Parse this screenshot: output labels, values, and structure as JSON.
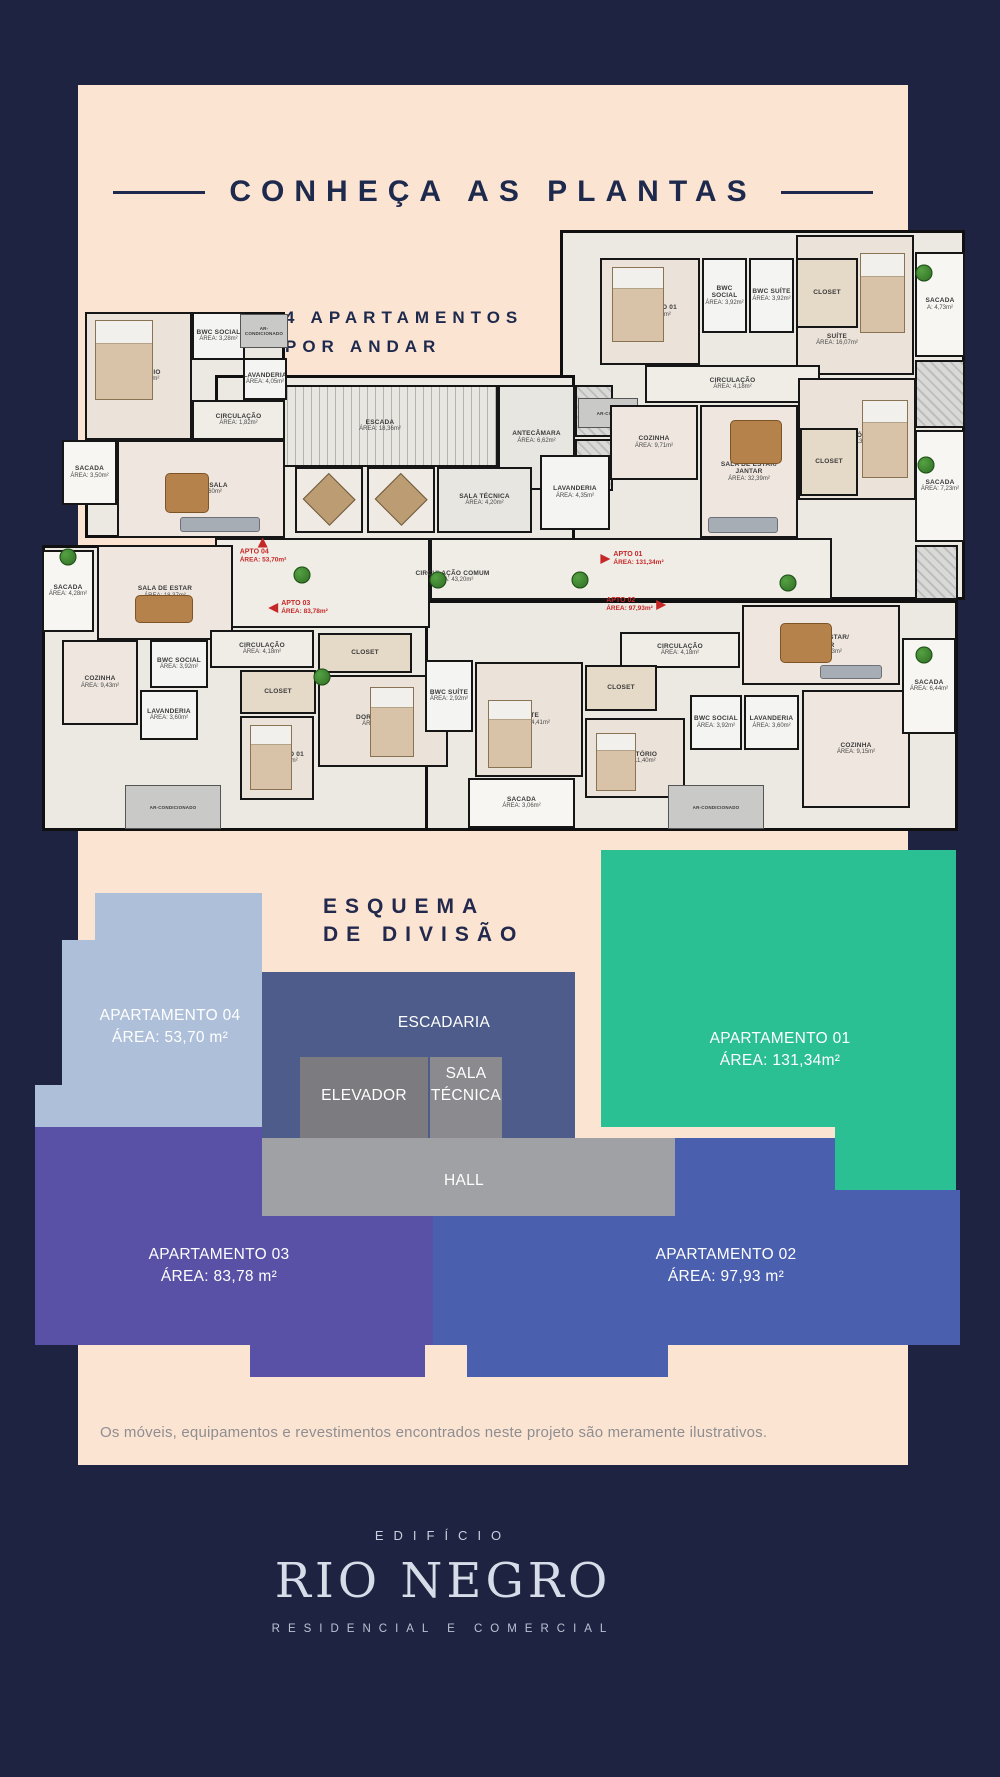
{
  "page": {
    "bg": "#1e2342",
    "card_bg": "#fce4d3",
    "accent_red": "#c62828",
    "navy": "#1e2a4d"
  },
  "header": {
    "title": "CONHEÇA AS PLANTAS",
    "subtitle_line1": "4 APARTAMENTOS",
    "subtitle_line2": "POR ANDAR"
  },
  "floor_plan": {
    "slabs": [
      [
        45,
        87,
        200,
        226
      ],
      [
        520,
        5,
        405,
        370
      ],
      [
        2,
        320,
        445,
        286
      ],
      [
        385,
        375,
        533,
        231
      ],
      [
        175,
        150,
        360,
        225
      ]
    ],
    "rooms": [
      {
        "n": "",
        "x": 175,
        "y": 313,
        "w": 215,
        "h": 90,
        "t": "corridor"
      },
      {
        "n": "",
        "x": 390,
        "y": 313,
        "w": 402,
        "h": 62,
        "t": "corridor"
      },
      {
        "n": "CIRCULAÇÃO COMUM",
        "a": "ÁREA: 43,20m²",
        "x": 330,
        "y": 332,
        "w": 165,
        "h": 40,
        "t": "labelonly"
      },
      {
        "n": "ESCADA",
        "a": "ÁREA: 18,36m²",
        "x": 222,
        "y": 160,
        "w": 236,
        "h": 82,
        "t": "stairs"
      },
      {
        "n": "ANTECÂMARA",
        "a": "ÁREA: 6,62m²",
        "x": 458,
        "y": 160,
        "w": 77,
        "h": 105,
        "t": "core"
      },
      {
        "n": "",
        "x": 535,
        "y": 160,
        "w": 38,
        "h": 52,
        "t": "hatch"
      },
      {
        "n": "",
        "x": 535,
        "y": 214,
        "w": 38,
        "h": 52,
        "t": "hatch"
      },
      {
        "n": "ELEVADOR",
        "x": 255,
        "y": 242,
        "w": 68,
        "h": 66,
        "t": "diamond"
      },
      {
        "n": "ELEVADOR",
        "x": 327,
        "y": 242,
        "w": 68,
        "h": 66,
        "t": "diamond"
      },
      {
        "n": "SALA TÉCNICA",
        "a": "ÁREA: 4,20m²",
        "x": 397,
        "y": 242,
        "w": 95,
        "h": 66,
        "t": "core"
      },
      {
        "n": "AR-COND",
        "x": 538,
        "y": 173,
        "w": 60,
        "h": 30,
        "t": "gray"
      },
      {
        "n": "DORMITÓRIO",
        "a": "ÁREA: 13,60m²",
        "x": 45,
        "y": 87,
        "w": 107,
        "h": 128,
        "t": "bed"
      },
      {
        "n": "BWC SOCIAL",
        "a": "ÁREA: 3,28m²",
        "x": 152,
        "y": 87,
        "w": 53,
        "h": 48,
        "t": "bath"
      },
      {
        "n": "AR-CONDICIONADO",
        "x": 200,
        "y": 89,
        "w": 48,
        "h": 34,
        "t": "gray"
      },
      {
        "n": "LAVANDERIA",
        "a": "ÁREA: 4,05m²",
        "x": 203,
        "y": 133,
        "w": 44,
        "h": 42,
        "t": "bath"
      },
      {
        "n": "CIRCULAÇÃO",
        "a": "ÁREA: 1,82m²",
        "x": 152,
        "y": 175,
        "w": 93,
        "h": 40,
        "t": "corridor"
      },
      {
        "n": "SACADA",
        "a": "ÁREA: 3,50m²",
        "x": 22,
        "y": 215,
        "w": 55,
        "h": 65,
        "t": "balcony"
      },
      {
        "n": "COZINHA/ SALA",
        "a": "ÁREA: 17,60m²",
        "x": 77,
        "y": 215,
        "w": 168,
        "h": 98,
        "t": "living"
      },
      {
        "n": "",
        "x": 756,
        "y": 10,
        "w": 118,
        "h": 140,
        "t": "bed"
      },
      {
        "n": "CLOSET",
        "x": 756,
        "y": 33,
        "w": 62,
        "h": 70,
        "t": "closet"
      },
      {
        "n": "SUÍTE",
        "a": "ÁREA: 16,07m²",
        "x": 752,
        "y": 100,
        "w": 90,
        "h": 30,
        "t": "labelonly"
      },
      {
        "n": "DORMITÓRIO 01",
        "a": "ÁREA: 12,74m²",
        "x": 560,
        "y": 33,
        "w": 100,
        "h": 107,
        "t": "bed"
      },
      {
        "n": "BWC SOCIAL",
        "a": "ÁREA: 3,92m²",
        "x": 662,
        "y": 33,
        "w": 45,
        "h": 75,
        "t": "bath"
      },
      {
        "n": "BWC SUÍTE",
        "a": "ÁREA: 3,92m²",
        "x": 709,
        "y": 33,
        "w": 45,
        "h": 75,
        "t": "bath"
      },
      {
        "n": "SACADA",
        "a": "A: 4,73m²",
        "x": 875,
        "y": 27,
        "w": 50,
        "h": 105,
        "t": "balcony"
      },
      {
        "n": "CIRCULAÇÃO",
        "a": "ÁREA: 4,18m²",
        "x": 605,
        "y": 140,
        "w": 175,
        "h": 38,
        "t": "corridor"
      },
      {
        "n": "COZINHA",
        "a": "ÁREA: 9,71m²",
        "x": 570,
        "y": 180,
        "w": 88,
        "h": 75,
        "t": "living"
      },
      {
        "n": "LAVANDERIA",
        "a": "ÁREA: 4,35m²",
        "x": 500,
        "y": 230,
        "w": 70,
        "h": 75,
        "t": "bath"
      },
      {
        "n": "DORMITÓRIO 02",
        "a": "ÁREA: 13,76m²",
        "x": 758,
        "y": 153,
        "w": 118,
        "h": 122,
        "t": "bed"
      },
      {
        "n": "CLOSET",
        "x": 760,
        "y": 203,
        "w": 58,
        "h": 68,
        "t": "closet"
      },
      {
        "n": [
          "SALA DE ESTAR/",
          "JANTAR"
        ],
        "a": "ÁREA: 32,39m²",
        "x": 660,
        "y": 180,
        "w": 98,
        "h": 133,
        "t": "living"
      },
      {
        "n": "SACADA",
        "a": "ÁREA: 7,23m²",
        "x": 875,
        "y": 205,
        "w": 50,
        "h": 112,
        "t": "balcony"
      },
      {
        "n": "",
        "x": 875,
        "y": 135,
        "w": 50,
        "h": 68,
        "t": "hatch"
      },
      {
        "n": "SACADA",
        "a": "ÁREA: 4,28m²",
        "x": 2,
        "y": 325,
        "w": 52,
        "h": 82,
        "t": "balcony"
      },
      {
        "n": "SALA DE ESTAR",
        "a": "ÁREA: 18,37m²",
        "x": 57,
        "y": 320,
        "w": 136,
        "h": 95,
        "t": "living"
      },
      {
        "n": "COZINHA",
        "a": "ÁREA: 9,43m²",
        "x": 22,
        "y": 415,
        "w": 76,
        "h": 85,
        "t": "living"
      },
      {
        "n": "BWC SOCIAL",
        "a": "ÁREA: 3,92m²",
        "x": 110,
        "y": 415,
        "w": 58,
        "h": 48,
        "t": "bath"
      },
      {
        "n": "LAVANDERIA",
        "a": "ÁREA: 3,60m²",
        "x": 100,
        "y": 465,
        "w": 58,
        "h": 50,
        "t": "bath"
      },
      {
        "n": "CIRCULAÇÃO",
        "a": "ÁREA: 4,18m²",
        "x": 170,
        "y": 405,
        "w": 104,
        "h": 38,
        "t": "corridor"
      },
      {
        "n": "CLOSET",
        "x": 200,
        "y": 445,
        "w": 76,
        "h": 44,
        "t": "closet"
      },
      {
        "n": "DORMITÓRIO 01",
        "a": "ÁREA: 11,40m²",
        "x": 200,
        "y": 491,
        "w": 74,
        "h": 84,
        "t": "bed"
      },
      {
        "n": "CLOSET",
        "x": 278,
        "y": 408,
        "w": 94,
        "h": 40,
        "t": "closet"
      },
      {
        "n": "DORMITÓRIO 02",
        "a": "ÁREA: 14,41m²",
        "x": 278,
        "y": 450,
        "w": 130,
        "h": 92,
        "t": "bed"
      },
      {
        "n": "AR-CONDICIONADO",
        "x": 85,
        "y": 560,
        "w": 96,
        "h": 44,
        "t": "gray"
      },
      {
        "n": "BWC SUÍTE",
        "a": "ÁREA: 2,92m²",
        "x": 385,
        "y": 435,
        "w": 48,
        "h": 72,
        "t": "bath"
      },
      {
        "n": "SUÍTE",
        "a": "ÁREA: 14,41m²",
        "x": 435,
        "y": 437,
        "w": 108,
        "h": 115,
        "t": "bed"
      },
      {
        "n": "SACADA",
        "a": "ÁREA: 3,06m²",
        "x": 428,
        "y": 553,
        "w": 107,
        "h": 50,
        "t": "balcony"
      },
      {
        "n": "CIRCULAÇÃO",
        "a": "ÁREA: 4,18m²",
        "x": 580,
        "y": 407,
        "w": 120,
        "h": 36,
        "t": "corridor"
      },
      {
        "n": "CLOSET",
        "x": 545,
        "y": 440,
        "w": 72,
        "h": 46,
        "t": "closet"
      },
      {
        "n": "DORMITÓRIO",
        "a": "ÁREA: 11,40m²",
        "x": 545,
        "y": 493,
        "w": 100,
        "h": 80,
        "t": "bed"
      },
      {
        "n": "BWC SOCIAL",
        "a": "ÁREA: 3,92m²",
        "x": 650,
        "y": 470,
        "w": 52,
        "h": 55,
        "t": "bath"
      },
      {
        "n": "LAVANDERIA",
        "a": "ÁREA: 3,60m²",
        "x": 704,
        "y": 470,
        "w": 55,
        "h": 55,
        "t": "bath"
      },
      {
        "n": "COZINHA",
        "a": "ÁREA: 9,15m²",
        "x": 762,
        "y": 465,
        "w": 108,
        "h": 118,
        "t": "living"
      },
      {
        "n": [
          "SALA DE ESTAR/",
          "JANTAR"
        ],
        "a": "ÁREA: 22,23m²",
        "x": 702,
        "y": 380,
        "w": 158,
        "h": 80,
        "t": "living"
      },
      {
        "n": "SACADA",
        "a": "ÁREA: 6,44m²",
        "x": 862,
        "y": 413,
        "w": 54,
        "h": 96,
        "t": "balcony"
      },
      {
        "n": "AR-CONDICIONADO",
        "x": 628,
        "y": 560,
        "w": 96,
        "h": 44,
        "t": "gray"
      },
      {
        "n": "",
        "x": 875,
        "y": 320,
        "w": 43,
        "h": 55,
        "t": "hatch"
      }
    ],
    "markers": [
      {
        "name": "APTO 04",
        "area": "ÁREA: 53,70m²",
        "x": 223,
        "y": 326,
        "dir": "up"
      },
      {
        "name": "APTO 01",
        "area": "ÁREA: 131,34m²",
        "x": 592,
        "y": 334,
        "dir": "right",
        "side": "left"
      },
      {
        "name": "APTO 03",
        "area": "ÁREA: 83,78m²",
        "x": 258,
        "y": 383,
        "dir": "left",
        "side": "left"
      },
      {
        "name": "APTO 02",
        "area": "ÁREA: 97,93m²",
        "x": 596,
        "y": 380,
        "dir": "right",
        "side": "right"
      }
    ],
    "plants": [
      [
        262,
        350
      ],
      [
        398,
        355
      ],
      [
        540,
        355
      ],
      [
        748,
        358
      ],
      [
        28,
        332
      ],
      [
        884,
        48
      ],
      [
        886,
        240
      ],
      [
        282,
        452
      ],
      [
        884,
        430
      ]
    ],
    "furniture": [
      {
        "t": "fbed",
        "x": 55,
        "y": 95,
        "w": 58,
        "h": 80
      },
      {
        "t": "fbed",
        "x": 572,
        "y": 42,
        "w": 52,
        "h": 75
      },
      {
        "t": "fbed",
        "x": 820,
        "y": 28,
        "w": 45,
        "h": 80
      },
      {
        "t": "fbed",
        "x": 822,
        "y": 175,
        "w": 46,
        "h": 78
      },
      {
        "t": "fbed",
        "x": 210,
        "y": 500,
        "w": 42,
        "h": 65
      },
      {
        "t": "fbed",
        "x": 330,
        "y": 462,
        "w": 44,
        "h": 70
      },
      {
        "t": "fbed",
        "x": 448,
        "y": 475,
        "w": 44,
        "h": 68
      },
      {
        "t": "fbed",
        "x": 556,
        "y": 508,
        "w": 40,
        "h": 58
      },
      {
        "t": "ftable",
        "x": 690,
        "y": 195,
        "w": 52,
        "h": 44
      },
      {
        "t": "ftable",
        "x": 740,
        "y": 398,
        "w": 52,
        "h": 40
      },
      {
        "t": "ftable",
        "x": 95,
        "y": 370,
        "w": 58,
        "h": 28
      },
      {
        "t": "ftable",
        "x": 125,
        "y": 248,
        "w": 44,
        "h": 40
      },
      {
        "t": "fsofa",
        "x": 668,
        "y": 292,
        "w": 70,
        "h": 16
      },
      {
        "t": "fsofa",
        "x": 780,
        "y": 440,
        "w": 62,
        "h": 14
      },
      {
        "t": "fsofa",
        "x": 140,
        "y": 292,
        "w": 80,
        "h": 15
      }
    ]
  },
  "esquema": {
    "heading_line1": "ESQUEMA",
    "heading_line2": "DE DIVISÃO",
    "blocks": [
      {
        "id": "ap04",
        "color": "#aebfd9",
        "rects": [
          [
            95,
            893,
            167,
            47
          ],
          [
            62,
            940,
            200,
            187
          ],
          [
            35,
            1085,
            27,
            105
          ]
        ],
        "label": [
          "APARTAMENTO 04",
          "ÁREA: 53,70 m²"
        ],
        "lx": 170,
        "ly": 1005
      },
      {
        "id": "escadaria",
        "color": "#4d5c8a",
        "rects": [
          [
            262,
            972,
            313,
            166
          ]
        ],
        "label": [
          "ESCADARIA"
        ],
        "lx": 444,
        "ly": 1012
      },
      {
        "id": "ap01",
        "color": "#2bbf94",
        "rects": [
          [
            601,
            850,
            234,
            277
          ],
          [
            835,
            850,
            121,
            340
          ]
        ],
        "label": [
          "APARTAMENTO 01",
          "ÁREA: 131,34m²"
        ],
        "lx": 780,
        "ly": 1028
      },
      {
        "id": "elevador",
        "color": "#7b7b80",
        "rects": [
          [
            300,
            1057,
            128,
            81
          ]
        ],
        "label": [
          "ELEVADOR"
        ],
        "lx": 364,
        "ly": 1085
      },
      {
        "id": "sala-tecnica",
        "color": "#8a8a8f",
        "rects": [
          [
            430,
            1057,
            72,
            81
          ]
        ],
        "label": [
          "SALA",
          "TÉCNICA"
        ],
        "lx": 466,
        "ly": 1063
      },
      {
        "id": "hall",
        "color": "#a0a1a5",
        "rects": [
          [
            254,
            1138,
            421,
            78
          ]
        ],
        "label": [
          "HALL"
        ],
        "lx": 464,
        "ly": 1170
      },
      {
        "id": "ap03",
        "color": "#5951a6",
        "rects": [
          [
            35,
            1127,
            227,
            89
          ],
          [
            35,
            1216,
            398,
            129
          ],
          [
            250,
            1345,
            175,
            32
          ]
        ],
        "label": [
          "APARTAMENTO 03",
          "ÁREA: 83,78 m²"
        ],
        "lx": 219,
        "ly": 1244
      },
      {
        "id": "ap02",
        "color": "#4a5fae",
        "rects": [
          [
            433,
            1216,
            242,
            129
          ],
          [
            675,
            1138,
            160,
            207
          ],
          [
            835,
            1190,
            125,
            155
          ],
          [
            467,
            1345,
            201,
            32
          ]
        ],
        "label": [
          "APARTAMENTO 02",
          "ÁREA: 97,93 m²"
        ],
        "lx": 726,
        "ly": 1244
      }
    ]
  },
  "disclaimer": "Os móveis, equipamentos e revestimentos encontrados neste projeto são meramente ilustrativos.",
  "footer": {
    "building": "EDIFÍCIO",
    "name": "RIO NEGRO",
    "tagline": "RESIDENCIAL E COMERCIAL"
  }
}
